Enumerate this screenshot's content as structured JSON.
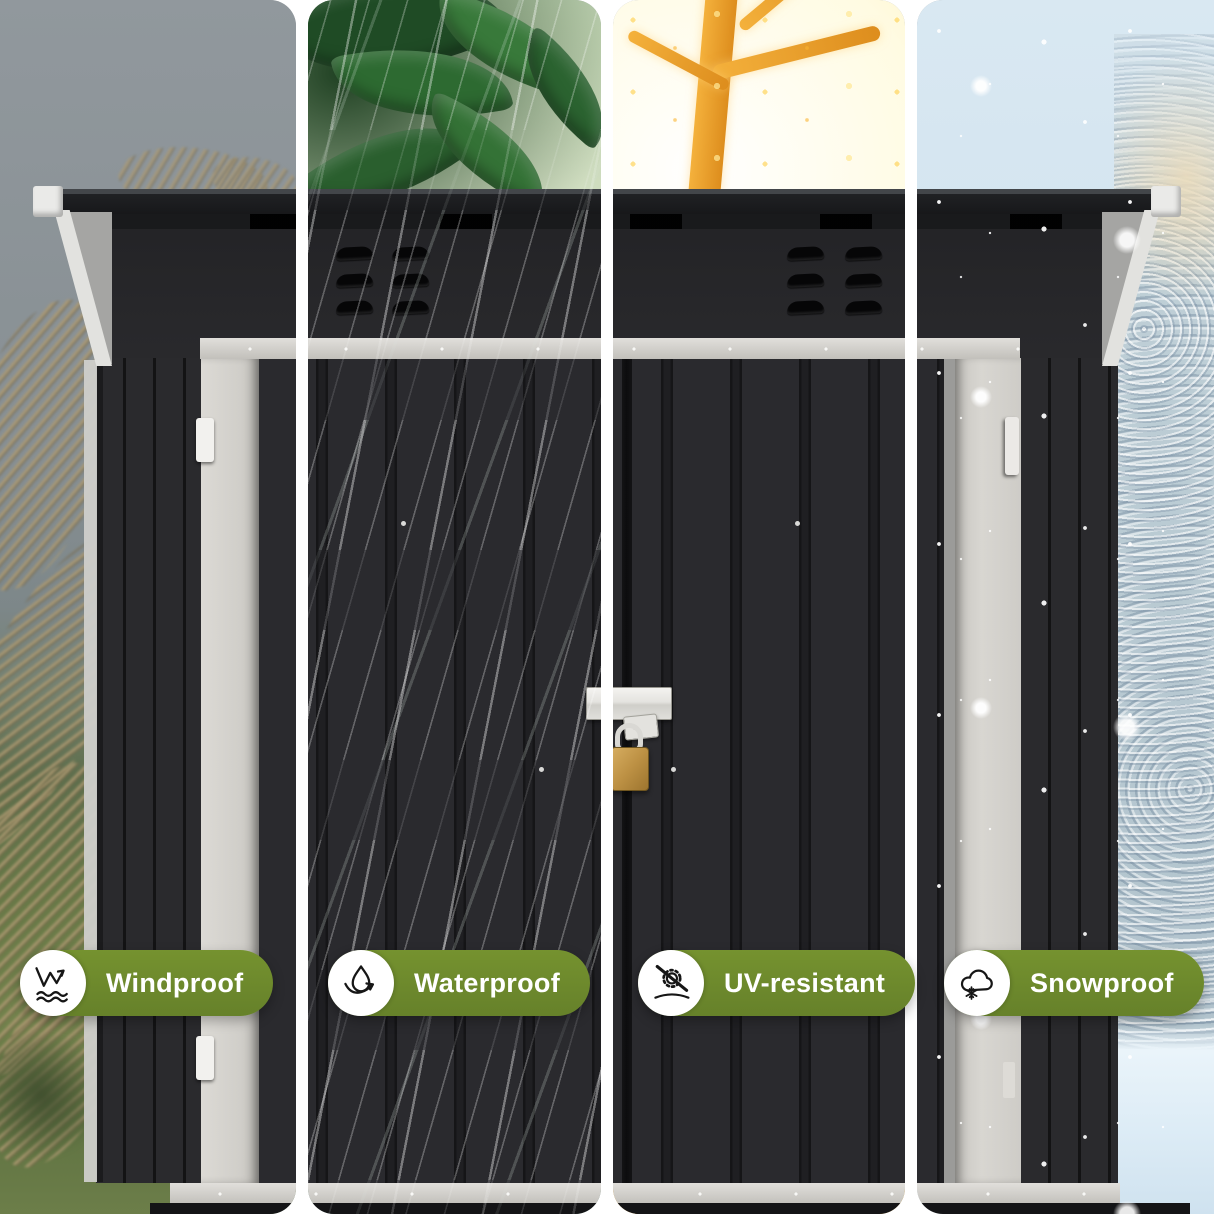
{
  "canvas": {
    "width": 1214,
    "height": 1214,
    "background": "#ffffff"
  },
  "features": [
    {
      "id": "windproof",
      "label": "Windproof",
      "icon": "wind-icon",
      "scene": "windy-field"
    },
    {
      "id": "waterproof",
      "label": "Waterproof",
      "icon": "water-drop-icon",
      "scene": "rain-on-leaves"
    },
    {
      "id": "uv",
      "label": "UV-resistant",
      "icon": "no-uv-sun-icon",
      "scene": "sunlit-tree"
    },
    {
      "id": "snowproof",
      "label": "Snowproof",
      "icon": "snow-cloud-icon",
      "scene": "winter-snowfall"
    }
  ],
  "badge_style": {
    "pill_color": "#6d8a2d",
    "text_color": "#ffffff",
    "icon_background": "#ffffff",
    "icon_stroke": "#161616"
  },
  "product_colors": {
    "shed_body": "#2a2a2e",
    "roof": "#161719",
    "white_trim": "#e2e2df",
    "rail": "#c9c7c2",
    "light_door": "#d5d3ce",
    "latch": "#e4e3df",
    "padlock_brass": "#bd9144"
  }
}
